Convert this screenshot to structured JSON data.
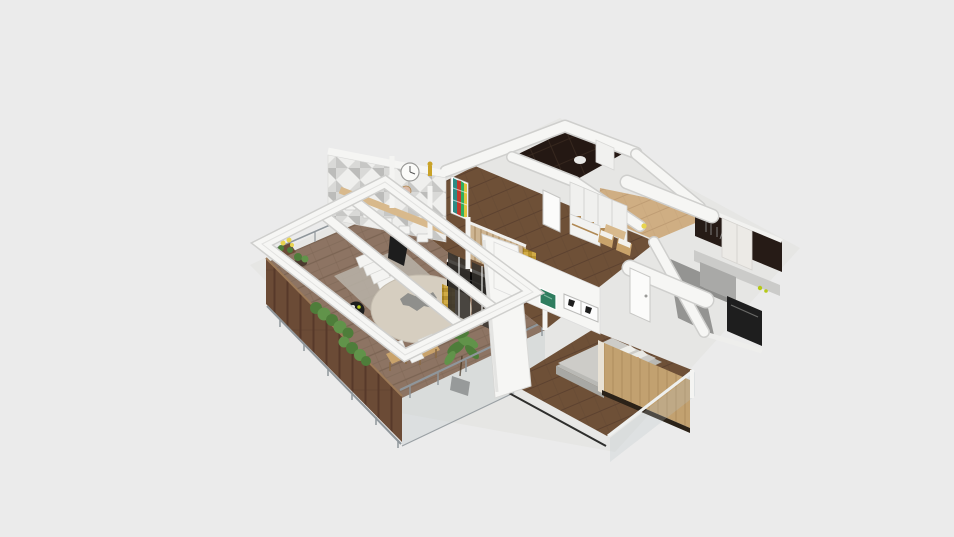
{
  "canvas": {
    "width": 954,
    "height": 537,
    "background": "#ebebeb"
  },
  "colors": {
    "background": "#ebebeb",
    "shadow": "#e2e2e0",
    "wall_white": "#f6f6f4",
    "wall_edge": "#cfcfcd",
    "wall_shade": "#e4e4e2",
    "deck_wood": "#8d7463",
    "deck_plank": "#7b6453",
    "fence_wood": "#6b4b36",
    "fence_plank": "#57392a",
    "floor_dark_wood": "#6e5037",
    "floor_dark_plank": "#5d4230",
    "floor_oak": "#cfae83",
    "floor_oak_plank": "#bf9d74",
    "marble_dark": "#241813",
    "marble_line": "#3a2a20",
    "kitchen_wall": "#261b16",
    "kitchen_floor": "#949492",
    "counter": "#cbcbc9",
    "island": "#a9a9a7",
    "appliance": "#1e1e1e",
    "cabinet_white": "#eceae6",
    "glass": "#b8c2c6",
    "metal": "#8f969b",
    "table_top": "#d6cec0",
    "table_rim": "#c4bcae",
    "table_item": "#8f8f8c",
    "rug": "#b9b3a8",
    "lounger": "#f4f4f2",
    "plant_green": "#4e7d3a",
    "plant_green_light": "#61934a",
    "flower_yellow": "#e8d44d",
    "pot_gray": "#8b8b89",
    "pot_dark": "#4a3a2e",
    "chair_wood": "#c9a36b",
    "cushion_white": "#f2f1ed",
    "wallpaper_base": "#efefed",
    "wallpaper_tri_a": "#d9d9d7",
    "wallpaper_tri_b": "#bcbcba",
    "wallpaper_tri_c": "#c7c7c5",
    "clock_face": "#fbfbf9",
    "clock_tan": "#d9b9a6",
    "gold": "#c9a227",
    "art_teal": "#2e8b85",
    "art_red": "#c23b2e",
    "art_green": "#2fae60",
    "art_yellow": "#e1c340",
    "bar_wood": "#d8b98c",
    "stool_white": "#f4f4f2",
    "chair_black": "#1d1d1d",
    "slat_wood": "#cdb491",
    "tv_black": "#0d0b09",
    "mosaic_gold": "#b8922f",
    "bed_base": "#a8a8a4",
    "bed_side": "#b9b9b5",
    "bed_top": "#cdccc8",
    "pillow_orange": "#c96a3a",
    "oak_panel": "#c2a170",
    "oak_panel_line": "#ae8d5e",
    "panel_shadow": "#2b2218",
    "frame_green": "#2f7d5f",
    "frame_white": "#fcfcfc",
    "door_white": "#fbfbfa",
    "glass_dark": "#35322e",
    "accent_lime": "#b6c919"
  }
}
